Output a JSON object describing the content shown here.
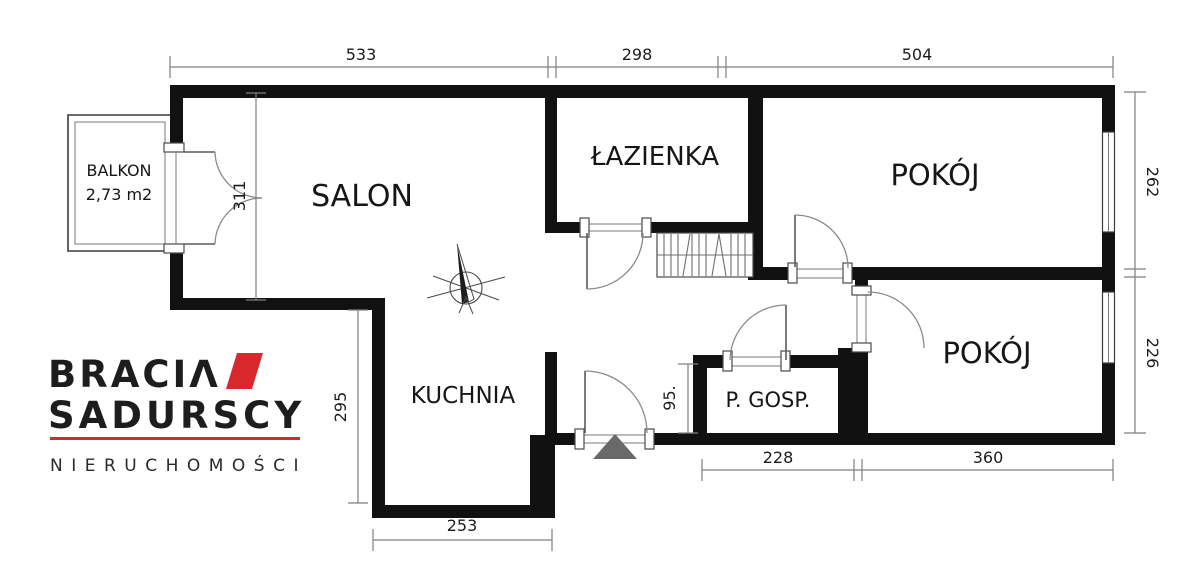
{
  "colors": {
    "wall": "#111111",
    "logo_red": "#d7282c",
    "dimension_line": "#7f7f7f",
    "entrance_marker": "#696969"
  },
  "logo": {
    "brand_top": "BRACIΛ",
    "brand_bottom": "SADURSCY",
    "tagline": "NIERUCHOMOŚCI"
  },
  "rooms": {
    "salon": "SALON",
    "lazienka": "ŁAZIENKA",
    "pokoj1": "POKÓJ",
    "pokoj2": "POKÓJ",
    "kuchnia": "KUCHNIA",
    "pgosp": "P. GOSP.",
    "balkon_label": "BALKON",
    "balkon_area": "2,73 m2"
  },
  "dimensions": {
    "top_533": "533",
    "top_298": "298",
    "top_504": "504",
    "right_262": "262",
    "right_226": "226",
    "left_311": "311",
    "left_295": "295",
    "inner_95": "95.",
    "bottom_228": "228",
    "bottom_360": "360",
    "bottom_253": "253"
  }
}
